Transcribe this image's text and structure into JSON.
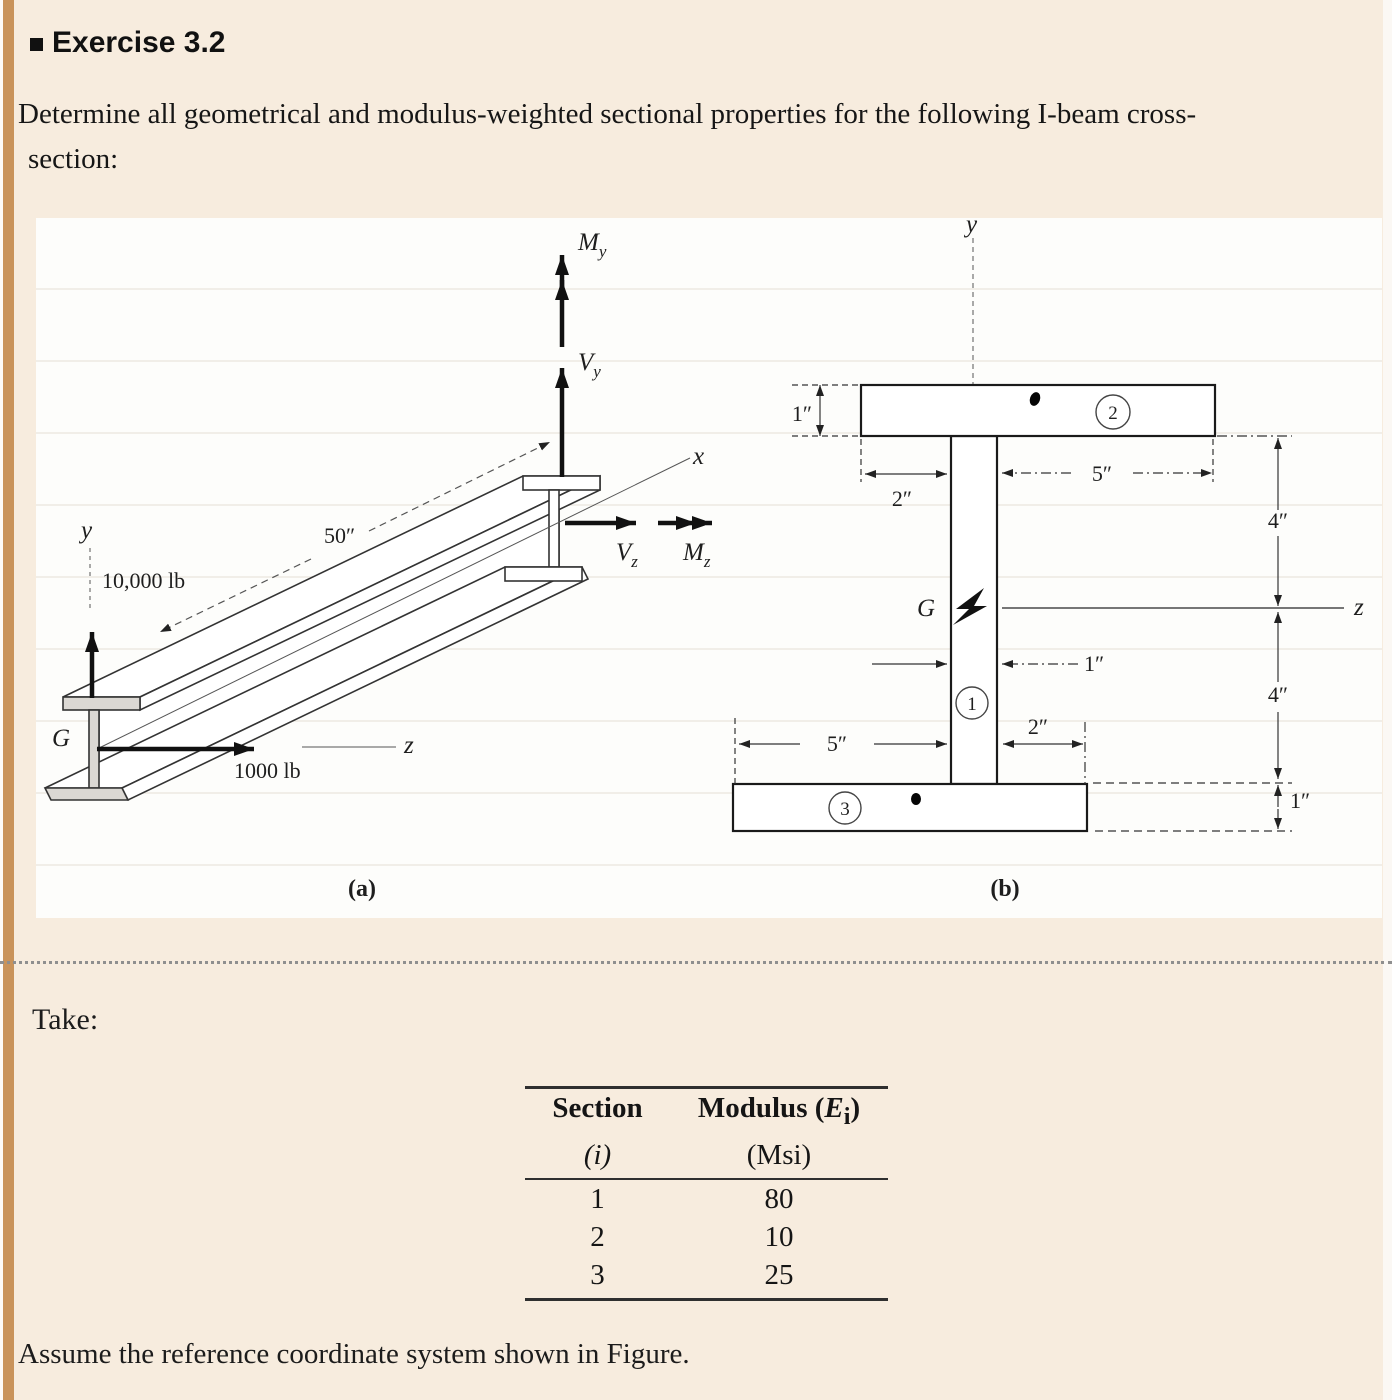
{
  "page": {
    "header": {
      "title": "Exercise 3.2"
    },
    "problem": {
      "line1": "Determine all geometrical and modulus-weighted sectional properties for the following I-beam cross-",
      "line2": "section:"
    },
    "take_label": "Take:",
    "footer": "Assume the reference coordinate system shown in Figure."
  },
  "figure": {
    "panel_a": {
      "caption": "(a)",
      "axis_x": "x",
      "axis_y": "y",
      "axis_z": "z",
      "centroid": "G",
      "length_dim": "50″",
      "force_vertical": "10,000 lb",
      "force_horizontal": "1000 lb",
      "moment_y": {
        "base": "M",
        "sub": "y"
      },
      "shear_y": {
        "base": "V",
        "sub": "y"
      },
      "shear_z": {
        "base": "V",
        "sub": "z"
      },
      "moment_z": {
        "base": "M",
        "sub": "z"
      }
    },
    "panel_b": {
      "caption": "(b)",
      "axis_y": "y",
      "axis_z": "z",
      "centroid": "G",
      "section_1": "1",
      "section_2": "2",
      "section_3": "3",
      "dim_top_flange_thickness": "1″",
      "dim_top_left_width": "2″",
      "dim_top_right_width": "5″",
      "dim_web_width": "1″",
      "dim_upper_height": "4″",
      "dim_lower_height": "4″",
      "dim_bottom_left_width": "5″",
      "dim_bottom_right_width": "2″",
      "dim_bottom_flange_thickness": "1″"
    }
  },
  "table": {
    "col1_header_line1": "Section",
    "col1_header_line2": "(i)",
    "col2_header_prefix": "Modulus (",
    "col2_header_var": "E",
    "col2_header_sub": "i",
    "col2_header_suffix": ")",
    "col2_header_line2": "(Msi)",
    "rows": [
      {
        "section": "1",
        "modulus": "80"
      },
      {
        "section": "2",
        "modulus": "10"
      },
      {
        "section": "3",
        "modulus": "25"
      }
    ]
  }
}
